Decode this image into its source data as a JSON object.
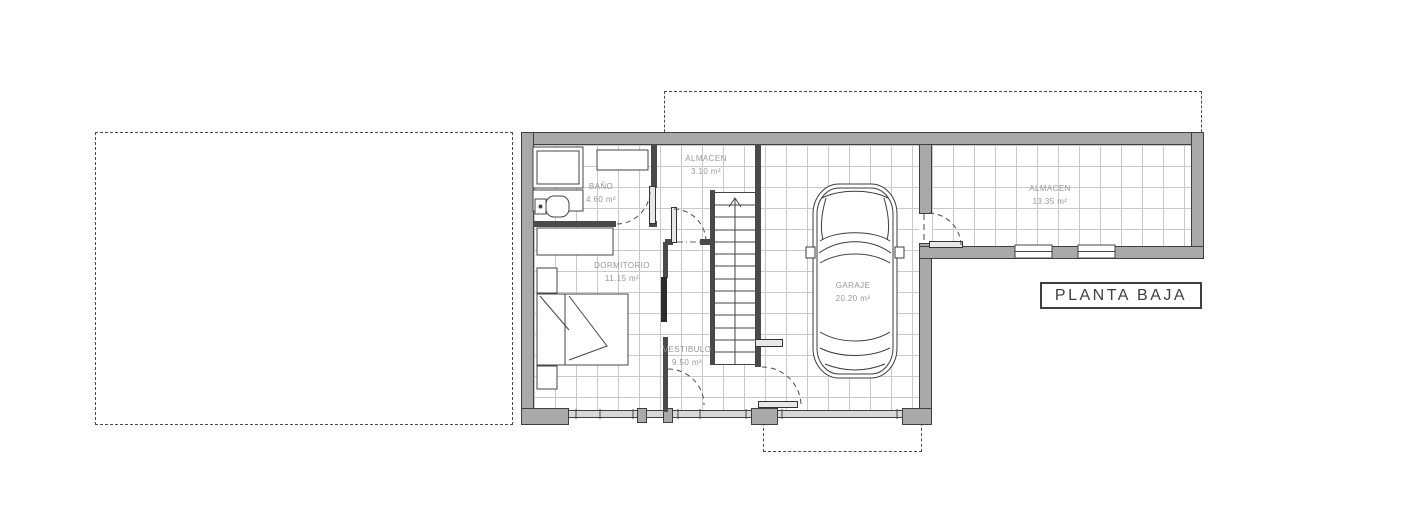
{
  "title_block": {
    "label": "PLANTA BAJA"
  },
  "rooms": [
    {
      "id": "bano",
      "name": "BAÑO",
      "area": "4.60 m²"
    },
    {
      "id": "almacen_1",
      "name": "ALMACEN",
      "area": "3.10 m²"
    },
    {
      "id": "dormitorio",
      "name": "DORMITORIO",
      "area": "11.15 m²"
    },
    {
      "id": "vestibulo",
      "name": "VESTIBULO",
      "area": "9.50 m²"
    },
    {
      "id": "garaje",
      "name": "GARAJE",
      "area": "20.20 m²"
    },
    {
      "id": "almacen_2",
      "name": "ALMACEN",
      "area": "13.35 m²"
    }
  ],
  "symbols": {
    "car": "car-top-view-icon",
    "stairs": "staircase-up-icon",
    "stair_direction": "up",
    "doors": "quarter-circle-swing-arcs",
    "plot_boundaries": "dashed-rectangles"
  },
  "colors": {
    "background": "#ffffff",
    "wall_fill": "#a9a9a9",
    "wall_edge": "#3f3f3f",
    "tile_grid": "#c9c9c9",
    "room_label": "#979797",
    "linework": "#444444",
    "dashed_boundary": "#4a4a4a",
    "title_text": "#3f3f3f"
  }
}
